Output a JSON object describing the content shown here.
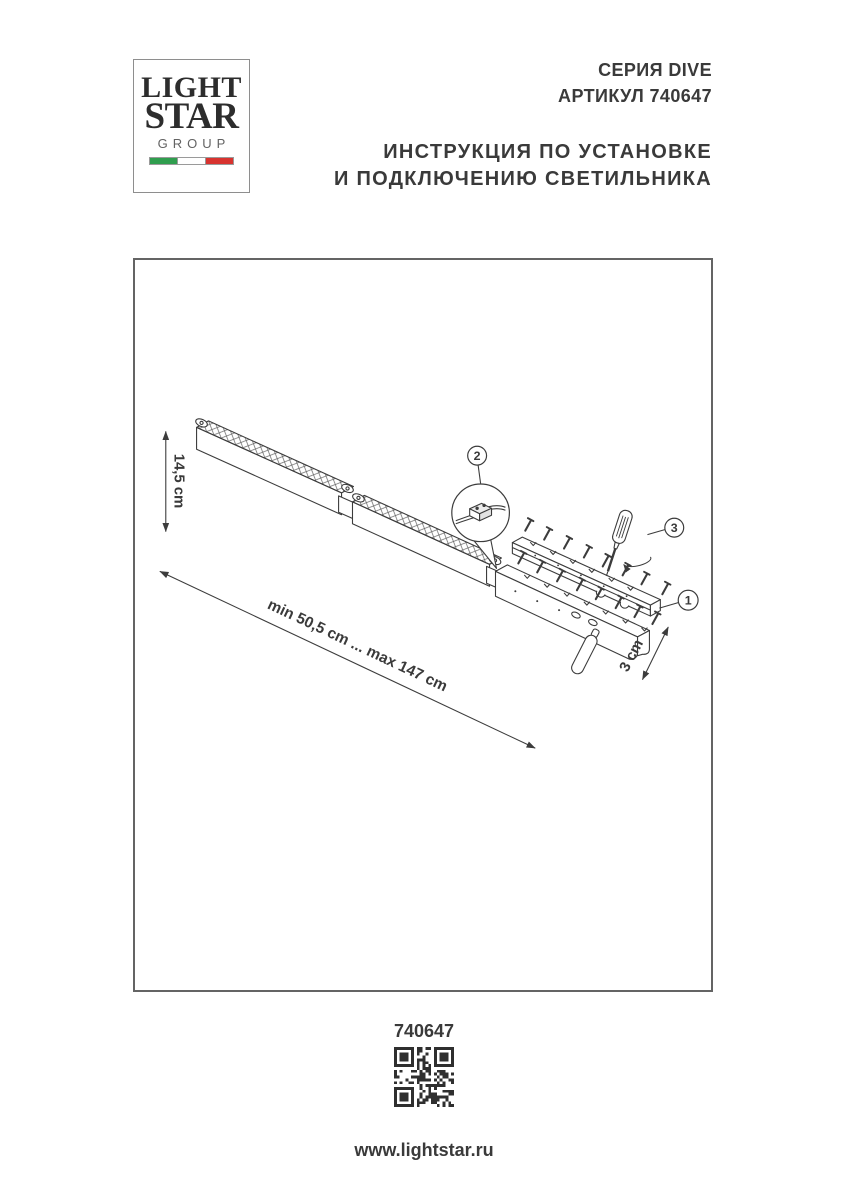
{
  "logo": {
    "line1": "LIGHT",
    "line2": "STAR",
    "line3": "GROUP",
    "flag_green": "#2f9e4e",
    "flag_white": "#ffffff",
    "flag_red": "#d8332f"
  },
  "header": {
    "series": "СЕРИЯ DIVE",
    "article": "АРТИКУЛ 740647",
    "title_line1": "ИНСТРУКЦИЯ ПО УСТАНОВКЕ",
    "title_line2": "И ПОДКЛЮЧЕНИЮ СВЕТИЛЬНИКА"
  },
  "diagram": {
    "dim_height": "14,5 cm",
    "dim_range": "min 50,5 cm ... max 147 cm",
    "dim_depth": "3 cm",
    "callout_1": "1",
    "callout_2": "2",
    "callout_3": "3"
  },
  "footer": {
    "article": "740647",
    "website": "www.lightstar.ru"
  },
  "colors": {
    "line": "#3c3c3c",
    "text": "#3a3a3a"
  }
}
